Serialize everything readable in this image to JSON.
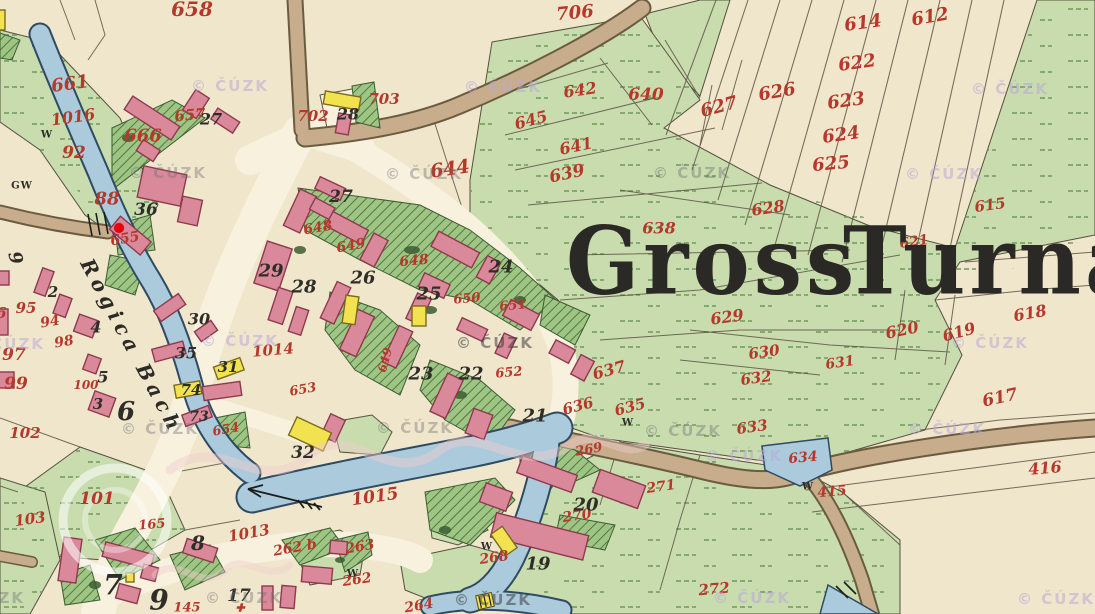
{
  "map": {
    "title": {
      "text": "Gross Turna",
      "words": [
        {
          "t": "Gross",
          "x": 566,
          "y": 205
        },
        {
          "t": "Turna",
          "x": 843,
          "y": 205
        }
      ]
    },
    "stream_label": {
      "t": "Rogica Bach",
      "x": 86,
      "y": 248,
      "r": 62
    },
    "watermark_text": "© ČÚZK",
    "marker": {
      "x": 119,
      "y": 228,
      "color": "#e8000d"
    },
    "colors": {
      "parcel_number_red": "#b5382b",
      "house_number_black": "#2f2d28",
      "building_pink": "#d9899a",
      "building_yellow": "#f2e24f",
      "meadow_green": "#c8dcae",
      "garden_green": "#9ec583",
      "water_blue": "#abcbdc",
      "road_tan": "#c7ad8c",
      "field_cream": "#f0e6cb"
    },
    "red_labels": [
      {
        "t": "658",
        "x": 192,
        "y": 9,
        "s": 20,
        "r": 0
      },
      {
        "t": "706",
        "x": 575,
        "y": 13,
        "s": 18,
        "r": -5
      },
      {
        "t": "614",
        "x": 863,
        "y": 23,
        "s": 18,
        "r": -8
      },
      {
        "t": "612",
        "x": 930,
        "y": 17,
        "s": 18,
        "r": -10
      },
      {
        "t": "622",
        "x": 857,
        "y": 63,
        "s": 18,
        "r": -8
      },
      {
        "t": "642",
        "x": 580,
        "y": 90,
        "s": 16,
        "r": -8
      },
      {
        "t": "640",
        "x": 646,
        "y": 95,
        "s": 17,
        "r": 0
      },
      {
        "t": "623",
        "x": 846,
        "y": 101,
        "s": 18,
        "r": -8
      },
      {
        "t": "626",
        "x": 777,
        "y": 92,
        "s": 18,
        "r": -10
      },
      {
        "t": "627",
        "x": 719,
        "y": 107,
        "s": 18,
        "r": -15
      },
      {
        "t": "624",
        "x": 841,
        "y": 135,
        "s": 18,
        "r": -8
      },
      {
        "t": "625",
        "x": 831,
        "y": 164,
        "s": 18,
        "r": -5
      },
      {
        "t": "661",
        "x": 70,
        "y": 84,
        "s": 18,
        "r": -8
      },
      {
        "t": "1016",
        "x": 73,
        "y": 117,
        "s": 16,
        "r": -8
      },
      {
        "t": "666",
        "x": 143,
        "y": 136,
        "s": 18,
        "r": 0
      },
      {
        "t": "657",
        "x": 190,
        "y": 115,
        "s": 15,
        "r": -5
      },
      {
        "t": "702",
        "x": 313,
        "y": 116,
        "s": 15,
        "r": 0
      },
      {
        "t": "703",
        "x": 384,
        "y": 99,
        "s": 15,
        "r": 0
      },
      {
        "t": "92",
        "x": 74,
        "y": 153,
        "s": 17,
        "r": 0
      },
      {
        "t": "644",
        "x": 450,
        "y": 169,
        "s": 19,
        "r": -8
      },
      {
        "t": "645",
        "x": 531,
        "y": 120,
        "s": 16,
        "r": -15
      },
      {
        "t": "641",
        "x": 576,
        "y": 146,
        "s": 16,
        "r": -12
      },
      {
        "t": "639",
        "x": 567,
        "y": 174,
        "s": 17,
        "r": -12
      },
      {
        "t": "88",
        "x": 107,
        "y": 199,
        "s": 18,
        "r": 0
      },
      {
        "t": "628",
        "x": 768,
        "y": 208,
        "s": 16,
        "r": -8
      },
      {
        "t": "638",
        "x": 659,
        "y": 228,
        "s": 16,
        "r": 0
      },
      {
        "t": "615",
        "x": 990,
        "y": 205,
        "s": 15,
        "r": -8
      },
      {
        "t": "621",
        "x": 914,
        "y": 242,
        "s": 14,
        "r": -8
      },
      {
        "t": "655",
        "x": 125,
        "y": 239,
        "s": 14,
        "r": -10
      },
      {
        "t": "648",
        "x": 318,
        "y": 228,
        "s": 14,
        "r": -10
      },
      {
        "t": "649",
        "x": 351,
        "y": 246,
        "s": 14,
        "r": -10
      },
      {
        "t": "648",
        "x": 414,
        "y": 261,
        "s": 14,
        "r": -5
      },
      {
        "t": "649",
        "x": 385,
        "y": 360,
        "s": 12,
        "r": -75
      },
      {
        "t": "650",
        "x": 467,
        "y": 299,
        "s": 13,
        "r": -5
      },
      {
        "t": "651",
        "x": 513,
        "y": 306,
        "s": 13,
        "r": -5
      },
      {
        "t": "652",
        "x": 509,
        "y": 373,
        "s": 13,
        "r": -5
      },
      {
        "t": "653",
        "x": 303,
        "y": 390,
        "s": 13,
        "r": -10
      },
      {
        "t": "654",
        "x": 226,
        "y": 430,
        "s": 13,
        "r": -10
      },
      {
        "t": "1014",
        "x": 273,
        "y": 350,
        "s": 15,
        "r": -5
      },
      {
        "t": "96",
        "x": -4,
        "y": 313,
        "s": 15,
        "r": 0
      },
      {
        "t": "95",
        "x": 26,
        "y": 308,
        "s": 15,
        "r": 0
      },
      {
        "t": "94",
        "x": 50,
        "y": 322,
        "s": 14,
        "r": -10
      },
      {
        "t": "98",
        "x": 64,
        "y": 342,
        "s": 14,
        "r": -10
      },
      {
        "t": "97",
        "x": 14,
        "y": 355,
        "s": 17,
        "r": 0
      },
      {
        "t": "99",
        "x": 16,
        "y": 384,
        "s": 17,
        "r": 0
      },
      {
        "t": "100",
        "x": 86,
        "y": 385,
        "s": 12,
        "r": 0
      },
      {
        "t": "102",
        "x": 25,
        "y": 433,
        "s": 15,
        "r": 0
      },
      {
        "t": "101",
        "x": 97,
        "y": 499,
        "s": 17,
        "r": 0
      },
      {
        "t": "103",
        "x": 30,
        "y": 519,
        "s": 15,
        "r": -8
      },
      {
        "t": "165",
        "x": 152,
        "y": 525,
        "s": 13,
        "r": -5
      },
      {
        "t": "145",
        "x": 187,
        "y": 608,
        "s": 13,
        "r": 0
      },
      {
        "t": "629",
        "x": 727,
        "y": 317,
        "s": 16,
        "r": -8
      },
      {
        "t": "630",
        "x": 764,
        "y": 352,
        "s": 15,
        "r": -8
      },
      {
        "t": "631",
        "x": 840,
        "y": 363,
        "s": 14,
        "r": -8
      },
      {
        "t": "632",
        "x": 756,
        "y": 378,
        "s": 15,
        "r": -8
      },
      {
        "t": "637",
        "x": 609,
        "y": 370,
        "s": 16,
        "r": -15
      },
      {
        "t": "636",
        "x": 578,
        "y": 406,
        "s": 15,
        "r": -15
      },
      {
        "t": "635",
        "x": 630,
        "y": 407,
        "s": 15,
        "r": -15
      },
      {
        "t": "620",
        "x": 902,
        "y": 330,
        "s": 16,
        "r": -12
      },
      {
        "t": "619",
        "x": 959,
        "y": 332,
        "s": 16,
        "r": -15
      },
      {
        "t": "618",
        "x": 1030,
        "y": 313,
        "s": 16,
        "r": -10
      },
      {
        "t": "617",
        "x": 1000,
        "y": 398,
        "s": 17,
        "r": -12
      },
      {
        "t": "633",
        "x": 752,
        "y": 427,
        "s": 15,
        "r": -8
      },
      {
        "t": "634",
        "x": 803,
        "y": 458,
        "s": 14,
        "r": -5
      },
      {
        "t": "416",
        "x": 1045,
        "y": 468,
        "s": 16,
        "r": -5
      },
      {
        "t": "415",
        "x": 832,
        "y": 492,
        "s": 14,
        "r": -5
      },
      {
        "t": "1015",
        "x": 375,
        "y": 497,
        "s": 17,
        "r": -8
      },
      {
        "t": "1013",
        "x": 249,
        "y": 533,
        "s": 15,
        "r": -10
      },
      {
        "t": "262 b",
        "x": 295,
        "y": 548,
        "s": 14,
        "r": -10
      },
      {
        "t": "263",
        "x": 360,
        "y": 547,
        "s": 14,
        "r": -10
      },
      {
        "t": "262",
        "x": 357,
        "y": 580,
        "s": 14,
        "r": -8
      },
      {
        "t": "264",
        "x": 419,
        "y": 606,
        "s": 14,
        "r": -10
      },
      {
        "t": "268",
        "x": 494,
        "y": 558,
        "s": 14,
        "r": -8
      },
      {
        "t": "269",
        "x": 589,
        "y": 450,
        "s": 13,
        "r": -10
      },
      {
        "t": "270",
        "x": 577,
        "y": 516,
        "s": 14,
        "r": -8
      },
      {
        "t": "271",
        "x": 661,
        "y": 487,
        "s": 14,
        "r": -8
      },
      {
        "t": "272",
        "x": 714,
        "y": 589,
        "s": 15,
        "r": -5
      }
    ],
    "black_labels": [
      {
        "t": "27",
        "x": 211,
        "y": 119,
        "s": 16,
        "r": 0
      },
      {
        "t": "28",
        "x": 348,
        "y": 114,
        "s": 16,
        "r": 0
      },
      {
        "t": "36",
        "x": 146,
        "y": 210,
        "s": 17,
        "r": 0
      },
      {
        "t": "27",
        "x": 341,
        "y": 197,
        "s": 17,
        "r": 0
      },
      {
        "t": "29",
        "x": 271,
        "y": 271,
        "s": 18,
        "r": 0
      },
      {
        "t": "28",
        "x": 304,
        "y": 287,
        "s": 18,
        "r": 0
      },
      {
        "t": "26",
        "x": 363,
        "y": 278,
        "s": 18,
        "r": 0
      },
      {
        "t": "25",
        "x": 429,
        "y": 294,
        "s": 18,
        "r": 0
      },
      {
        "t": "24",
        "x": 501,
        "y": 267,
        "s": 18,
        "r": 0
      },
      {
        "t": "23",
        "x": 421,
        "y": 374,
        "s": 18,
        "r": 0
      },
      {
        "t": "22",
        "x": 471,
        "y": 374,
        "s": 18,
        "r": 0
      },
      {
        "t": "21",
        "x": 535,
        "y": 416,
        "s": 18,
        "r": 0
      },
      {
        "t": "20",
        "x": 586,
        "y": 505,
        "s": 18,
        "r": 0
      },
      {
        "t": "19",
        "x": 538,
        "y": 564,
        "s": 18,
        "r": 0
      },
      {
        "t": "32",
        "x": 303,
        "y": 453,
        "s": 17,
        "r": 0
      },
      {
        "t": "30",
        "x": 199,
        "y": 319,
        "s": 16,
        "r": 0
      },
      {
        "t": "35",
        "x": 186,
        "y": 353,
        "s": 16,
        "r": 0
      },
      {
        "t": "31",
        "x": 228,
        "y": 367,
        "s": 15,
        "r": 0
      },
      {
        "t": "74",
        "x": 191,
        "y": 390,
        "s": 15,
        "r": 0
      },
      {
        "t": "73",
        "x": 199,
        "y": 417,
        "s": 14,
        "r": 0
      },
      {
        "t": "4",
        "x": 96,
        "y": 327,
        "s": 16,
        "r": 0
      },
      {
        "t": "5",
        "x": 103,
        "y": 377,
        "s": 16,
        "r": 0
      },
      {
        "t": "3",
        "x": 98,
        "y": 404,
        "s": 15,
        "r": 0
      },
      {
        "t": "2",
        "x": 53,
        "y": 292,
        "s": 15,
        "r": 0
      },
      {
        "t": "6",
        "x": 126,
        "y": 412,
        "s": 26,
        "r": 0
      },
      {
        "t": "9",
        "x": 15,
        "y": 258,
        "s": 18,
        "r": 75
      },
      {
        "t": "7",
        "x": 113,
        "y": 585,
        "s": 28,
        "r": 0
      },
      {
        "t": "9",
        "x": 159,
        "y": 600,
        "s": 28,
        "r": 0
      },
      {
        "t": "8",
        "x": 198,
        "y": 543,
        "s": 20,
        "r": 0
      },
      {
        "t": "17",
        "x": 239,
        "y": 596,
        "s": 17,
        "r": 0
      }
    ],
    "symbol_labels": [
      {
        "t": "GW",
        "x": 22,
        "y": 186
      },
      {
        "t": "W",
        "x": 47,
        "y": 135
      },
      {
        "t": "W",
        "x": 487,
        "y": 547
      },
      {
        "t": "W",
        "x": 353,
        "y": 574
      },
      {
        "t": "W",
        "x": 628,
        "y": 423
      },
      {
        "t": "W",
        "x": 808,
        "y": 487
      }
    ],
    "cross_symbol": {
      "t": "✚",
      "x": 240,
      "y": 608
    },
    "watermarks": [
      {
        "x": 230,
        "y": 86,
        "v": "l"
      },
      {
        "x": 168,
        "y": 173,
        "v": "g"
      },
      {
        "x": 503,
        "y": 87,
        "v": "l"
      },
      {
        "x": 424,
        "y": 174,
        "v": "g"
      },
      {
        "x": 1010,
        "y": 89,
        "v": "l"
      },
      {
        "x": 692,
        "y": 173,
        "v": "g"
      },
      {
        "x": 944,
        "y": 174,
        "v": "l"
      },
      {
        "x": 240,
        "y": 341,
        "v": "l"
      },
      {
        "x": 495,
        "y": 343,
        "v": "d"
      },
      {
        "x": 6,
        "y": 344,
        "v": "l"
      },
      {
        "x": 990,
        "y": 343,
        "v": "l"
      },
      {
        "x": 160,
        "y": 429,
        "v": "g"
      },
      {
        "x": 415,
        "y": 428,
        "v": "g"
      },
      {
        "x": 683,
        "y": 431,
        "v": "g"
      },
      {
        "x": 744,
        "y": 456,
        "v": "l"
      },
      {
        "x": 947,
        "y": 429,
        "v": "l"
      },
      {
        "x": -14,
        "y": 598,
        "v": "g"
      },
      {
        "x": 244,
        "y": 598,
        "v": "g"
      },
      {
        "x": 493,
        "y": 600,
        "v": "d"
      },
      {
        "x": 752,
        "y": 598,
        "v": "l"
      },
      {
        "x": 1056,
        "y": 599,
        "v": "l"
      }
    ]
  }
}
